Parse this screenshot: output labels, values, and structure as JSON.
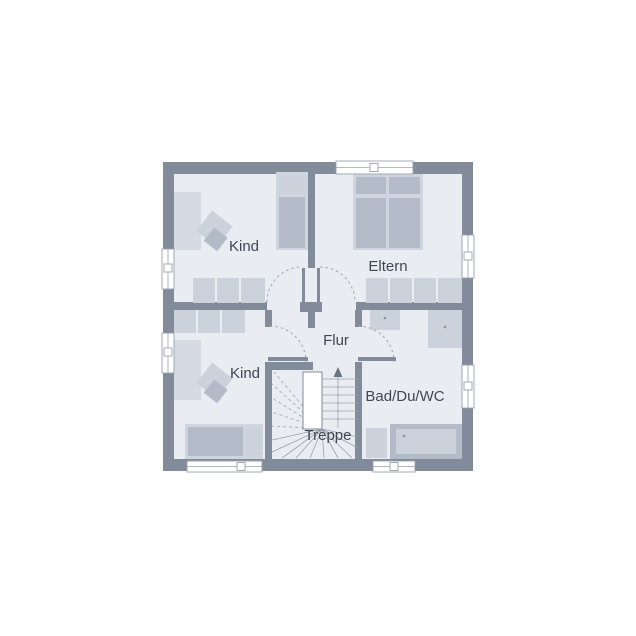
{
  "rooms": [
    {
      "id": "kind-top-left",
      "label": "Kind"
    },
    {
      "id": "eltern",
      "label": "Eltern"
    },
    {
      "id": "flur",
      "label": "Flur"
    },
    {
      "id": "kind-bottom-left",
      "label": "Kind"
    },
    {
      "id": "bad",
      "label": "Bad/Du/WC"
    },
    {
      "id": "treppe",
      "label": "Treppe"
    }
  ],
  "colors": {
    "background": "#ffffff",
    "wall": "#828b99",
    "floor": "#e9edf2",
    "furniture": "#b3bbc8",
    "furniture_light": "#cfd5de",
    "furniture_mid": "#ccd2dc",
    "furniture_pale": "#d6dbe3",
    "text": "#3f4654",
    "door_arc": "#a2aab5",
    "stair_line": "#9aa2ad"
  }
}
